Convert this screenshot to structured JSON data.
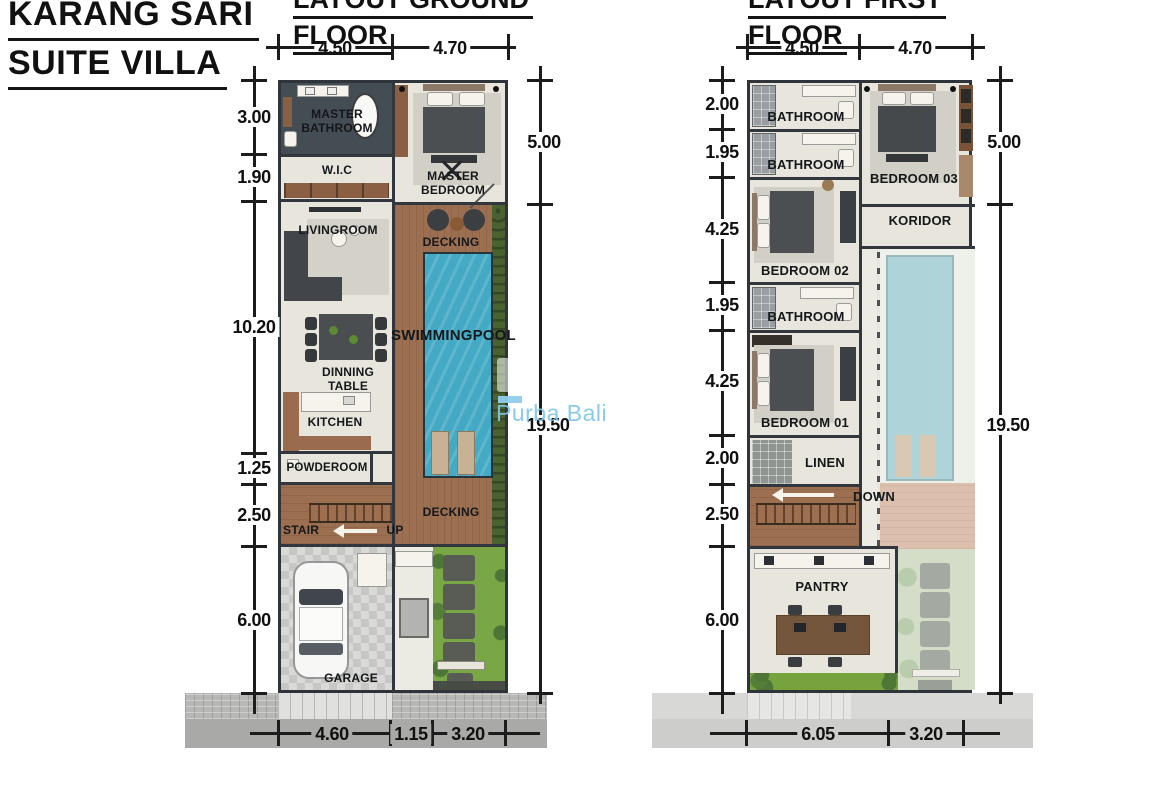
{
  "project": {
    "title_line1": "KARANG SARI",
    "title_line2": "SUITE VILLA"
  },
  "watermark": {
    "text": "Purba Bali",
    "color": "#80c5e9"
  },
  "ground": {
    "title_line1": "LAYOUT GROUND",
    "title_line2": "FLOOR",
    "dims": {
      "top": [
        "4.50",
        "4.70"
      ],
      "left": [
        "3.00",
        "1.90",
        "10.20",
        "1.25",
        "2.50",
        "6.00"
      ],
      "right": [
        "5.00",
        "19.50"
      ],
      "bottom": [
        "4.60",
        "1.15",
        "3.20"
      ]
    },
    "labels": {
      "master_bathroom": "MASTER BATHROOM",
      "wic": "W.I.C",
      "master_bedroom": "MASTER BEDROOM",
      "livingroom": "LIVINGROOM",
      "decking_top": "DECKING",
      "swimmingpool": "SWIMMINGPOOL",
      "dinning_table": "DINNING TABLE",
      "kitchen": "KITCHEN",
      "powderoom": "POWDEROOM",
      "stair": "STAIR",
      "up": "UP",
      "decking_bottom": "DECKING",
      "garage": "GARAGE"
    }
  },
  "first": {
    "title_line1": "LAYOUT FIRST",
    "title_line2": "FLOOR",
    "dims": {
      "top": [
        "4.50",
        "4.70"
      ],
      "left": [
        "2.00",
        "1.95",
        "4.25",
        "1.95",
        "4.25",
        "2.00",
        "2.50",
        "6.00"
      ],
      "right": [
        "5.00",
        "19.50"
      ],
      "bottom": [
        "6.05",
        "3.20"
      ]
    },
    "labels": {
      "bathroom_1": "BATHROOM",
      "bathroom_2": "BATHROOM",
      "bedroom_03": "BEDROOM 03",
      "koridor": "KORIDOR",
      "bedroom_02": "BEDROOM 02",
      "bathroom_3": "BATHROOM",
      "bedroom_01": "BEDROOM 01",
      "linen": "LINEN",
      "down": "DOWN",
      "pantry": "PANTRY"
    }
  },
  "colors": {
    "pool": "#44a9c4",
    "pool_faded": "#aed3d8",
    "deck_wood": "#9c6f51",
    "grass": "#79a746",
    "hedge": "#4a6230",
    "bath_tile_dark": "#454d54",
    "pavement": "#a9a9a7",
    "dim_line": "#1c1c1c"
  }
}
